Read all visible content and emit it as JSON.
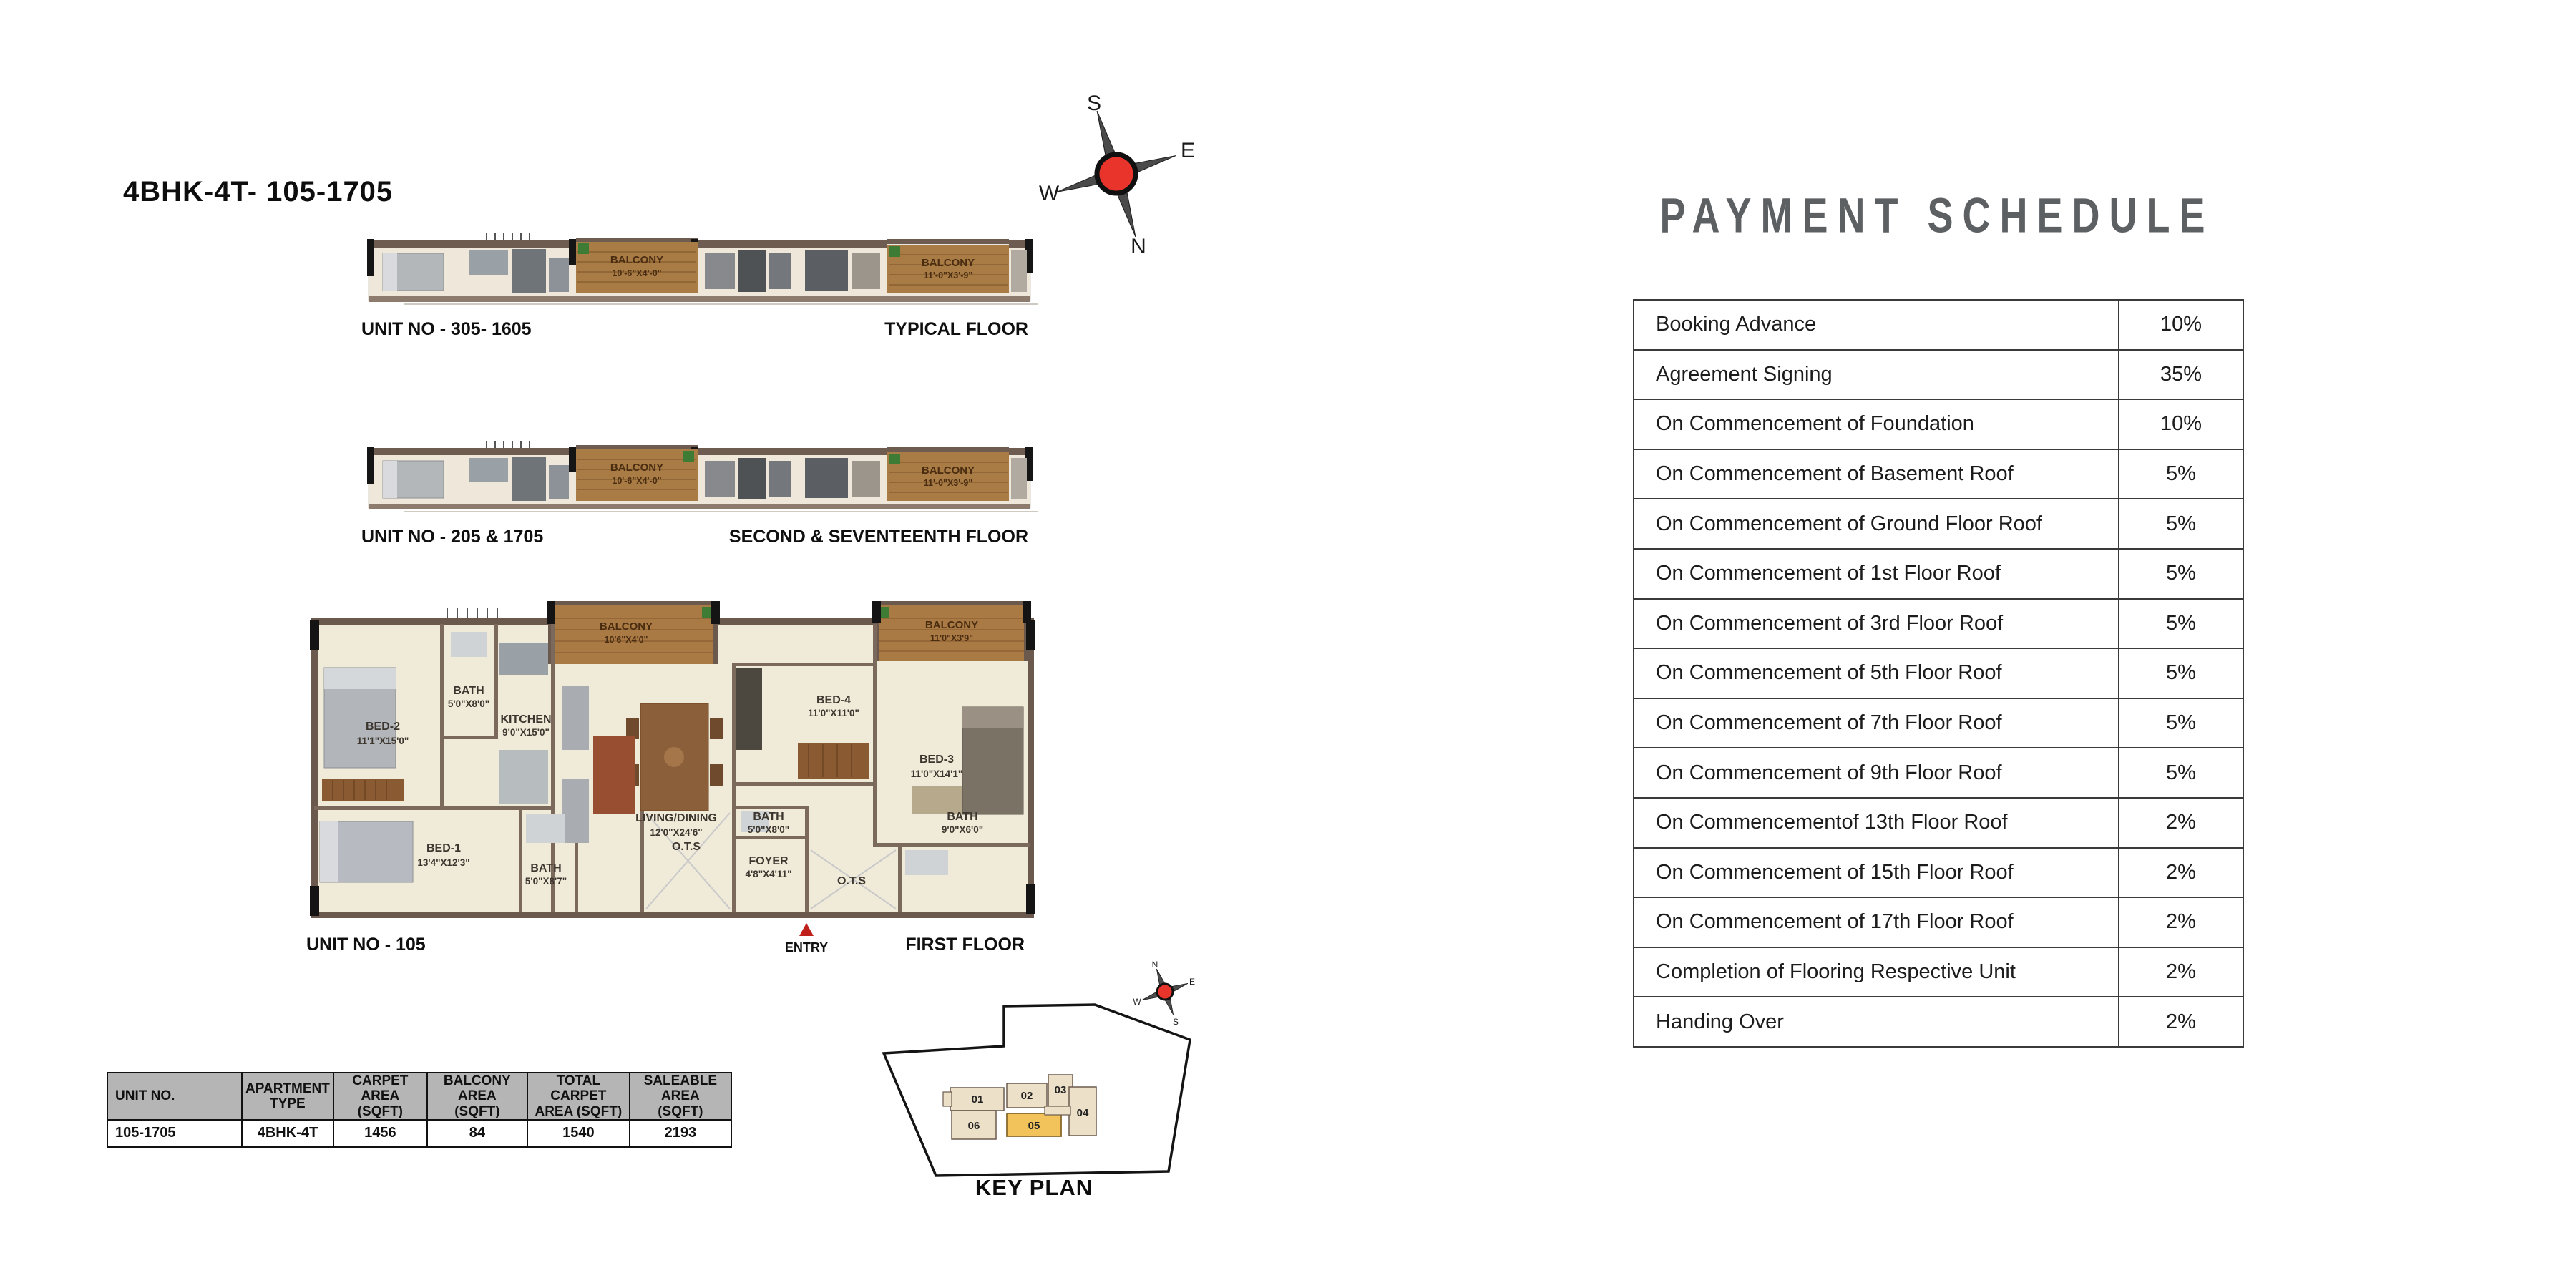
{
  "page": {
    "plan_title": "4BHK-4T- 105-1705"
  },
  "compass_main": {
    "top": "S",
    "right": "E",
    "left": "W",
    "bottom": "N"
  },
  "strips": [
    {
      "unit_label": "UNIT NO - 305- 1605",
      "floor_label": "TYPICAL FLOOR",
      "balcony1": {
        "name": "BALCONY",
        "dims": "10'-6\"X4'-0\""
      },
      "balcony2": {
        "name": "BALCONY",
        "dims": "11'-0\"X3'-9\""
      }
    },
    {
      "unit_label": "UNIT NO - 205 & 1705",
      "floor_label": "SECOND & SEVENTEENTH FLOOR",
      "balcony1": {
        "name": "BALCONY",
        "dims": "10'-6\"X4'-0\""
      },
      "balcony2": {
        "name": "BALCONY",
        "dims": "11'-0\"X3'-9\""
      }
    }
  ],
  "main_plan": {
    "unit_label": "UNIT NO - 105",
    "floor_label": "FIRST FLOOR",
    "entry_label": "ENTRY",
    "rooms": {
      "bed2": {
        "name": "BED-2",
        "dims": "11'1\"X15'0\""
      },
      "bath_top": {
        "name": "BATH",
        "dims": "5'0\"X8'0\""
      },
      "kitchen": {
        "name": "KITCHEN",
        "dims": "9'0\"X15'0\""
      },
      "balcony1": {
        "name": "BALCONY",
        "dims": "10'6\"X4'0\""
      },
      "bed4": {
        "name": "BED-4",
        "dims": "11'0\"X11'0\""
      },
      "balcony2": {
        "name": "BALCONY",
        "dims": "11'0\"X3'9\""
      },
      "bed3": {
        "name": "BED-3",
        "dims": "11'0\"X14'1\""
      },
      "living": {
        "name": "LIVING/DINING",
        "dims": "12'0\"X24'6\""
      },
      "bed1": {
        "name": "BED-1",
        "dims": "13'4\"X12'3\""
      },
      "bath_bl": {
        "name": "BATH",
        "dims": "5'0\"X8'7\""
      },
      "ots_left": {
        "name": "O.T.S"
      },
      "bath_mid": {
        "name": "BATH",
        "dims": "5'0\"X8'0\""
      },
      "foyer": {
        "name": "FOYER",
        "dims": "4'8\"X4'11\""
      },
      "bath_right": {
        "name": "BATH",
        "dims": "9'0\"X6'0\""
      },
      "ots_right": {
        "name": "O.T.S"
      }
    }
  },
  "area_table": {
    "headers": [
      "UNIT NO.",
      "APARTMENT\nTYPE",
      "CARPET AREA\n(SQFT)",
      "BALCONY AREA\n(SQFT)",
      "TOTAL CARPET\nAREA (SQFT)",
      "SALEABLE AREA\n(SQFT)"
    ],
    "row": [
      "105-1705",
      "4BHK-4T",
      "1456",
      "84",
      "1540",
      "2193"
    ]
  },
  "key_plan": {
    "title": "KEY PLAN",
    "units": [
      "01",
      "02",
      "03",
      "04",
      "05",
      "06"
    ],
    "highlight_unit": "05",
    "highlight_color": "#f2c35b",
    "compass": {
      "top": "N",
      "right": "E",
      "left": "W",
      "bottom": "S"
    }
  },
  "payment": {
    "title": "PAYMENT SCHEDULE",
    "title_color": "#5c6063",
    "rows": [
      {
        "label": "Booking Advance",
        "value": "10%"
      },
      {
        "label": "Agreement Signing",
        "value": "35%"
      },
      {
        "label": "On Commencement of Foundation",
        "value": "10%"
      },
      {
        "label": "On Commencement of Basement Roof",
        "value": "5%"
      },
      {
        "label": "On Commencement of Ground Floor Roof",
        "value": "5%"
      },
      {
        "label": "On Commencement of 1st Floor Roof",
        "value": "5%"
      },
      {
        "label": "On Commencement of 3rd Floor Roof",
        "value": "5%"
      },
      {
        "label": "On Commencement of 5th Floor Roof",
        "value": "5%"
      },
      {
        "label": "On Commencement of 7th Floor Roof",
        "value": "5%"
      },
      {
        "label": "On Commencement of 9th Floor Roof",
        "value": "5%"
      },
      {
        "label": "On Commencementof 13th Floor Roof",
        "value": "2%"
      },
      {
        "label": "On Commencement of 15th Floor Roof",
        "value": "2%"
      },
      {
        "label": "On Commencement of 17th Floor Roof",
        "value": "2%"
      },
      {
        "label": "Completion of Flooring Respective Unit",
        "value": "2%"
      },
      {
        "label": "Handing Over",
        "value": "2%"
      }
    ]
  }
}
